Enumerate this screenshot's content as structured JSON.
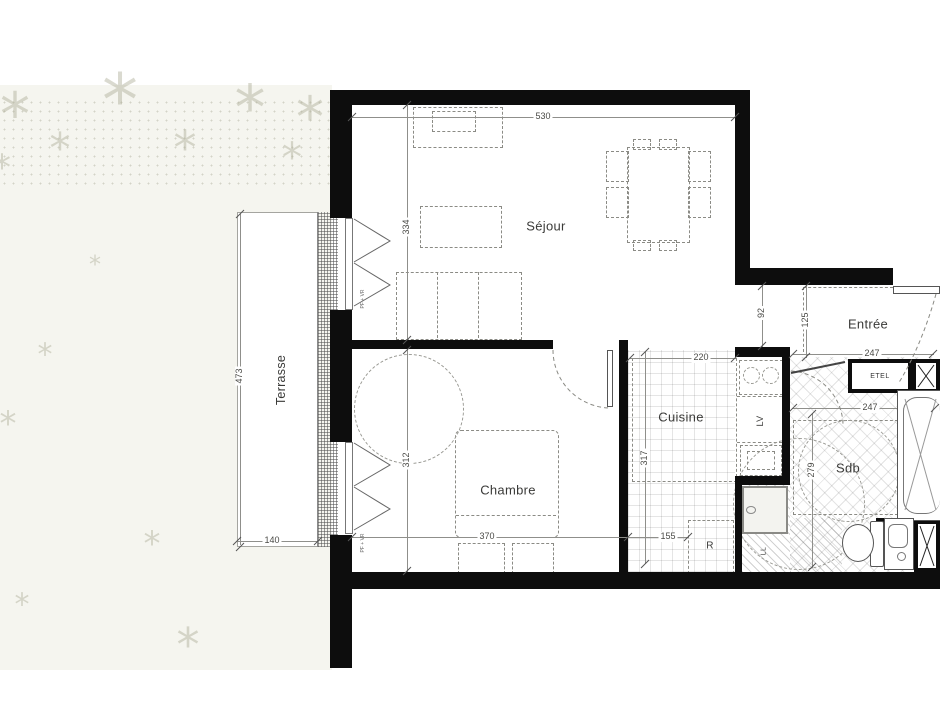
{
  "plan": {
    "rooms": {
      "sejour": "Séjour",
      "chambre": "Chambre",
      "cuisine": "Cuisine",
      "sdb": "Sdb",
      "entree": "Entrée",
      "terrasse": "Terrasse"
    },
    "fixtures": {
      "etel": "ETEL",
      "lv": "LV",
      "fridge": "R",
      "washer": "LL",
      "window_note": "PF + VR"
    },
    "dims": {
      "sejour_w": "530",
      "sejour_d": "334",
      "terrasse_d": "473",
      "terrasse_w": "140",
      "chambre_d": "312",
      "chambre_w": "370",
      "cuisine_w": "220",
      "cuisine_d": "317",
      "fridge_w": "155",
      "passage": "92",
      "entree_d": "125",
      "entree_w": "247",
      "sdb_w": "247",
      "sdb_d": "279"
    },
    "colors": {
      "wall": "#0d0d0d",
      "outdoor": "#f5f5ef",
      "dim_line": "#8f8f8b",
      "text": "#3a3a38"
    }
  }
}
